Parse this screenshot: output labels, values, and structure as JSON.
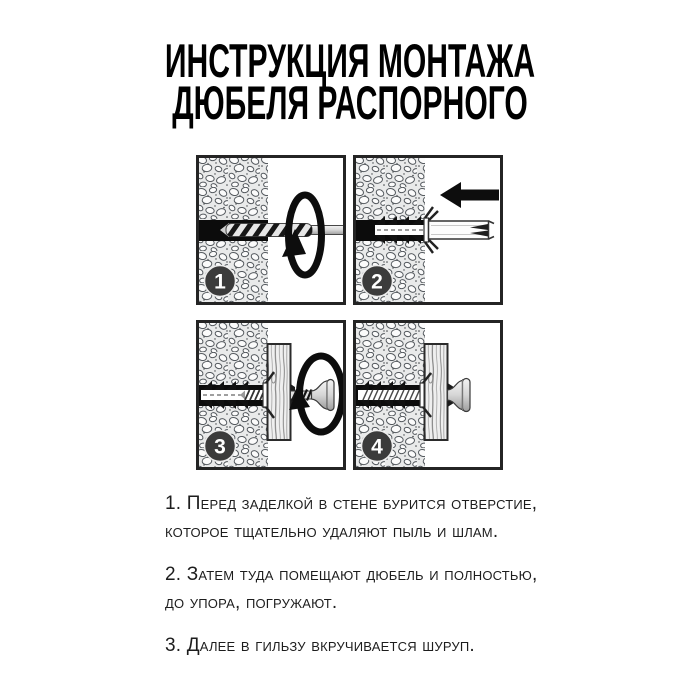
{
  "title": {
    "line1": "ИНСТРУКЦИЯ МОНТАЖА",
    "line2": "ДЮБЕЛЯ РАСПОРНОГО"
  },
  "figure": {
    "panels": [
      {
        "number": "1",
        "icon": "rotation-arrow",
        "depicts": "бурение отверстия"
      },
      {
        "number": "2",
        "icon": "insert-left-arrow",
        "depicts": "установка дюбеля"
      },
      {
        "number": "3",
        "icon": "rotation-arrow",
        "depicts": "вкручивание шурупа"
      },
      {
        "number": "4",
        "icon": "none",
        "depicts": "готовый монтаж"
      }
    ]
  },
  "steps": [
    "1. Перед заделкой в стене бурится отверстие,\nкоторое тщательно удаляют пыль и шлам.",
    "2. Затем туда помещают дюбель и полностью,\nдо упора, погружают.",
    "3. Далее в гильзу вкручивается шуруп."
  ],
  "colors": {
    "ink": "#0d0d0d",
    "badge": "#3b3b3b",
    "text": "#1d1d1d",
    "background": "#ffffff"
  }
}
